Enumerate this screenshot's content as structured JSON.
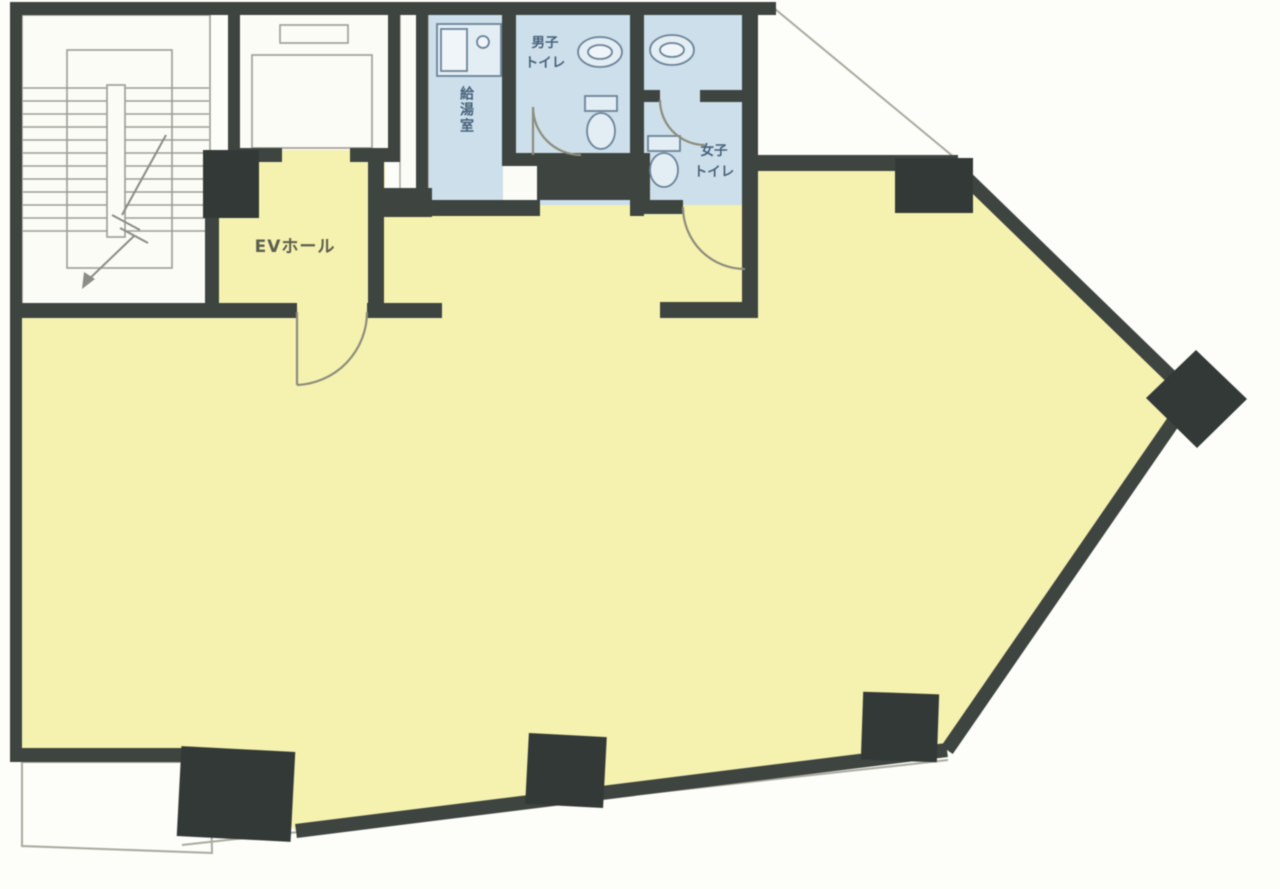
{
  "plan": {
    "type": "building-floor-plan",
    "rooms": {
      "ev_hall": {
        "label": "EVホール"
      },
      "kitchenette": {
        "label": "給湯室"
      },
      "mens_toilet": {
        "label_line1": "男子",
        "label_line2": "トイレ"
      },
      "womens_toilet": {
        "label_line1": "女子",
        "label_line2": "トイレ"
      }
    },
    "colors": {
      "leased_area_fill": "#f5f1af",
      "wet_area_fill": "#ccdfeb",
      "wall": "#3e4440",
      "column": "#333937",
      "thin_line": "#9b9e94",
      "fixture_line": "#6b8499"
    }
  }
}
